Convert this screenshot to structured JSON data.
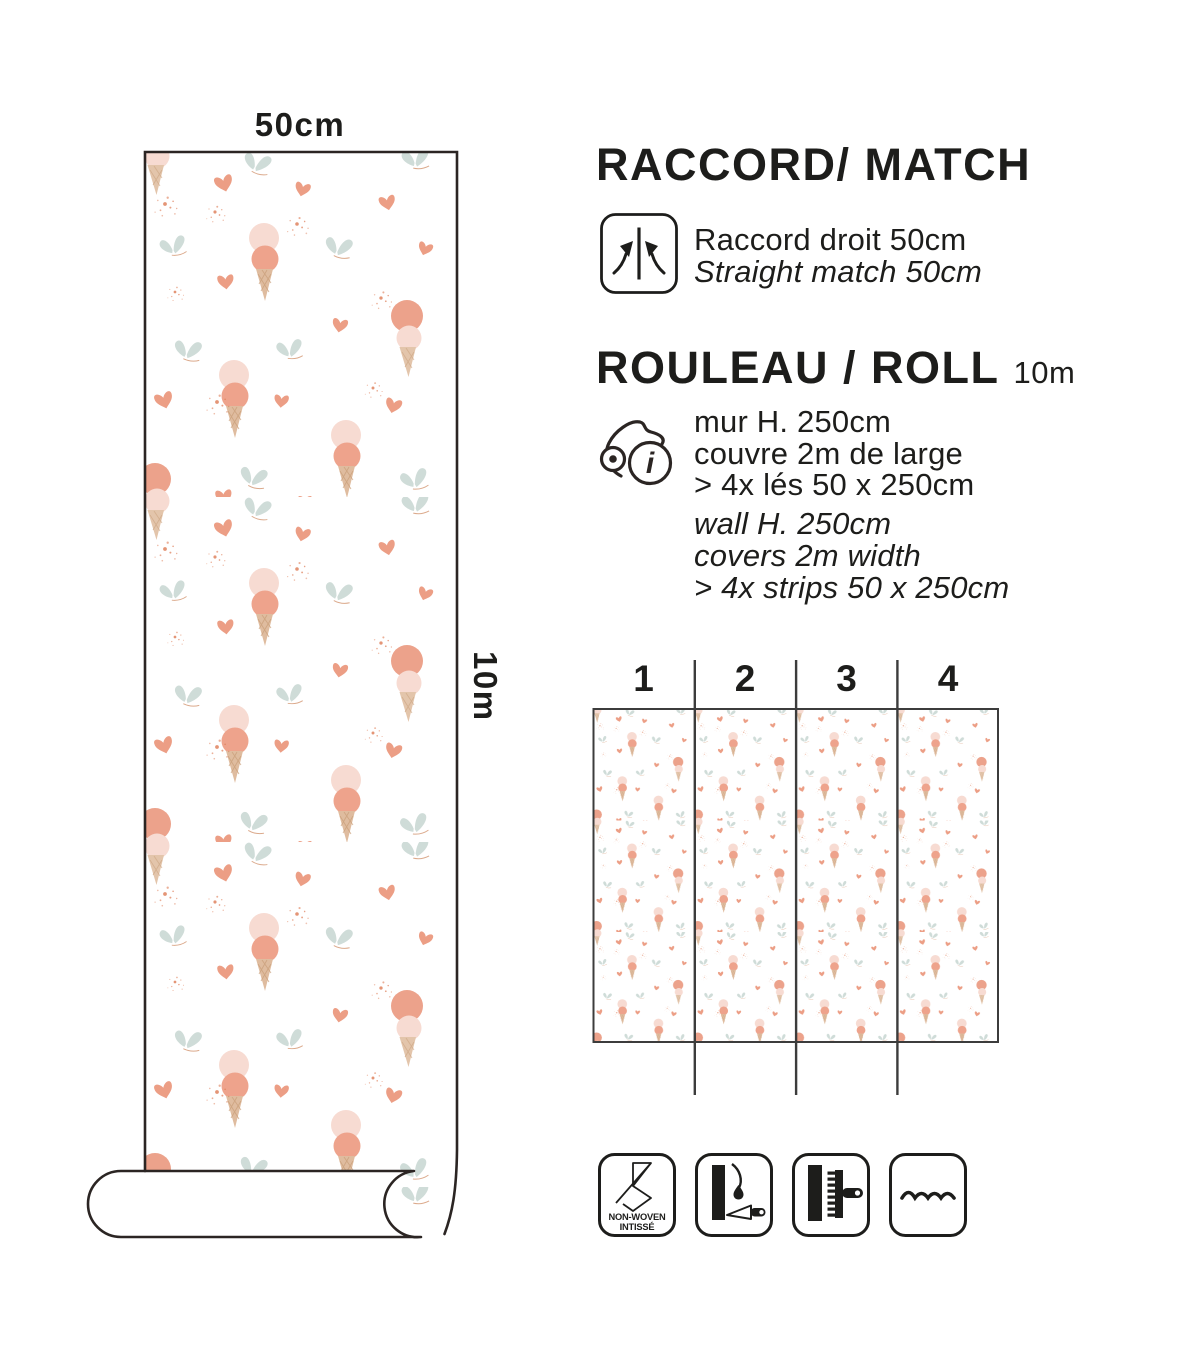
{
  "page": {
    "background": "#ffffff",
    "text_color": "#1d1d1b",
    "outline_color": "#2b2523",
    "diagram_line_color": "#3c3c3c"
  },
  "roll_figure": {
    "width_label": "50cm",
    "length_label": "10m"
  },
  "match_section": {
    "title": "RACCORD/ MATCH",
    "fr": "Raccord droit 50cm",
    "en": "Straight match 50cm",
    "icon": "straight-match-icon"
  },
  "roll_section": {
    "title": "ROULEAU / ROLL",
    "length_badge": "10m",
    "icon": "roll-info-icon",
    "info_glyph": "i",
    "fr_lines": [
      "mur H. 250cm",
      "couvre 2m de large",
      "> 4x lés 50 x 250cm"
    ],
    "en_lines": [
      "wall H. 250cm",
      "covers 2m width",
      "> 4x strips 50 x 250cm"
    ]
  },
  "strips_diagram": {
    "labels": [
      "1",
      "2",
      "3",
      "4"
    ]
  },
  "feature_icons": {
    "non_woven_line1": "NON-WOVEN",
    "non_woven_line2": "INTISSÉ",
    "names": [
      "non-woven-icon",
      "paste-the-wall-icon",
      "smoothing-brush-icon",
      "washable-icon"
    ]
  },
  "pattern_colors": {
    "scoop_light": "#f7dbd2",
    "scoop_dark": "#eea38c",
    "cone": "#dfbc9f",
    "cone_lattice": "#c99e78",
    "heart": "#ec9e85",
    "butterfly": "#cfdcd8",
    "butterfly_body": "#dba98b",
    "splatter": "#dd7b54"
  }
}
